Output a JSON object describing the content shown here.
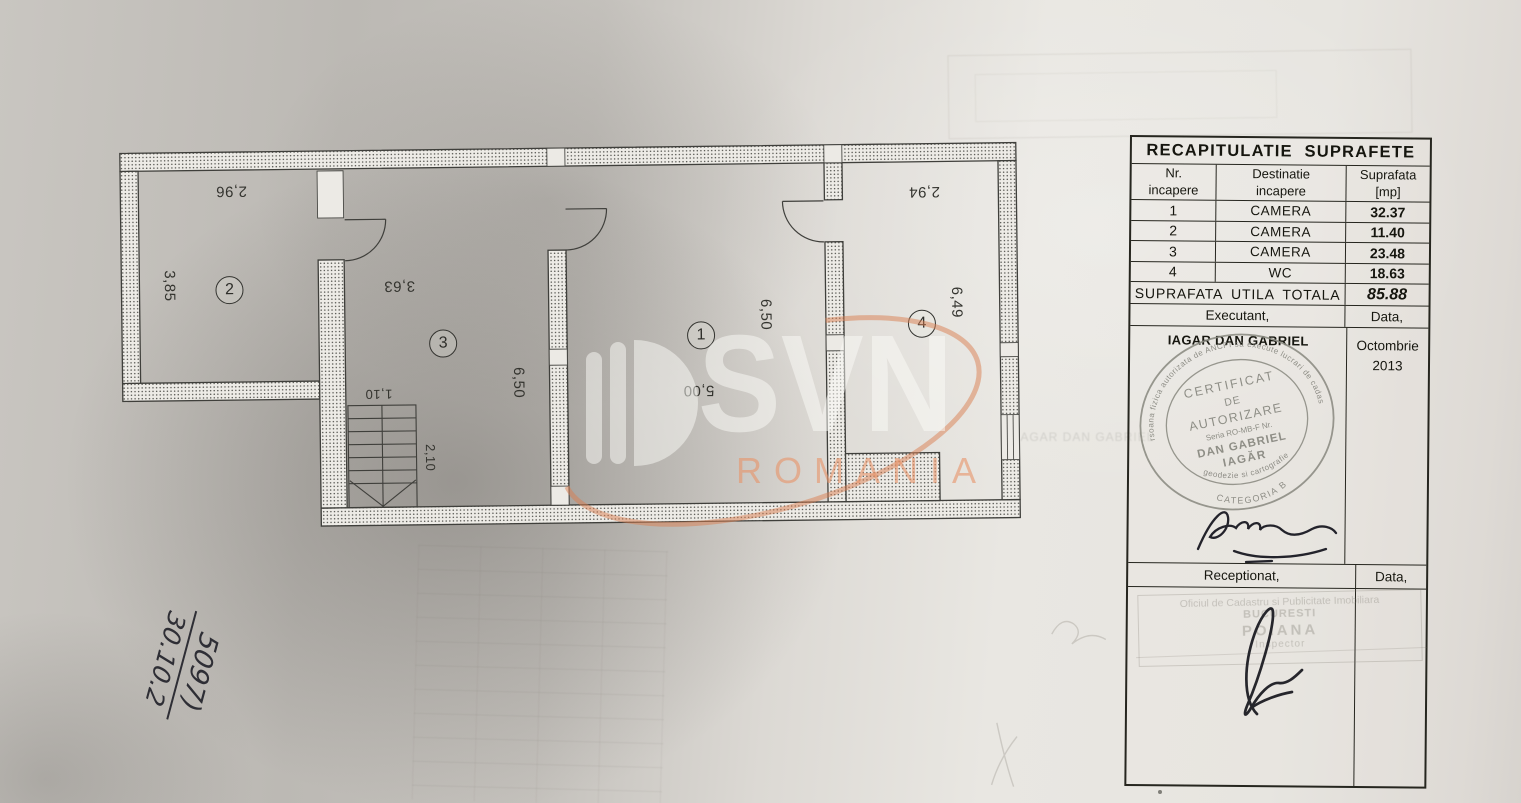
{
  "watermark": {
    "brand": "SVN",
    "country": "ROMANIA",
    "swoosh_color": "#d97e4f"
  },
  "note": {
    "number": "5097)",
    "date": "30.10.2"
  },
  "plan": {
    "room_numbers": {
      "r1": "1",
      "r2": "2",
      "r3": "3",
      "r4": "4"
    },
    "dims": {
      "r2_w": "2,96",
      "r2_h": "3,85",
      "r3_w": "3,63",
      "r3_h": "6,50",
      "r1_w": "5,00",
      "r1_h": "6,50",
      "r4_w": "2,94",
      "r4_h": "6,49",
      "stair_w": "1,10",
      "stair_run": "2,10"
    }
  },
  "table": {
    "title": "RECAPITULATIE SUPRAFETE",
    "headers": {
      "c1a": "Nr.",
      "c1b": "incapere",
      "c2a": "Destinatie",
      "c2b": "incapere",
      "c3a": "Suprafata",
      "c3b": "[mp]"
    },
    "rows": [
      {
        "nr": "1",
        "dest": "CAMERA",
        "mp": "32.37"
      },
      {
        "nr": "2",
        "dest": "CAMERA",
        "mp": "11.40"
      },
      {
        "nr": "3",
        "dest": "CAMERA",
        "mp": "23.48"
      },
      {
        "nr": "4",
        "dest": "WC",
        "mp": "18.63"
      }
    ],
    "total_label": "SUPRAFATA UTILA TOTALA",
    "total_value": "85.88",
    "executant_label": "Executant,",
    "executant_date_label": "Data,",
    "executant_name": "IAGAR DAN GABRIEL",
    "date_month": "Octombrie",
    "date_year": "2013",
    "receptionat_label": "Receptionat,",
    "receptionat_date_label": "Data,"
  },
  "stamp": {
    "arc_top": "persoana fizica autorizata de ANCPI sa execute lucrari de cadastru",
    "arc_bottom": "geodezie si cartografie",
    "line1": "CERTIFICAT",
    "line2": "DE",
    "line3": "AUTORIZARE",
    "line4": "Seria RO-MB-F Nr.",
    "line5": "DAN GABRIEL",
    "line6": "IAGĂR",
    "category": "CATEGORIA B"
  },
  "faint_stamp": {
    "line1": "Oficiul de Cadastru si Publicitate Imobiliara",
    "line2": "BUCURESTI",
    "line3": "POIANA",
    "line4": "Inspector"
  },
  "bleed": {
    "name_echo": "IAGAR DAN GABRIEL"
  }
}
